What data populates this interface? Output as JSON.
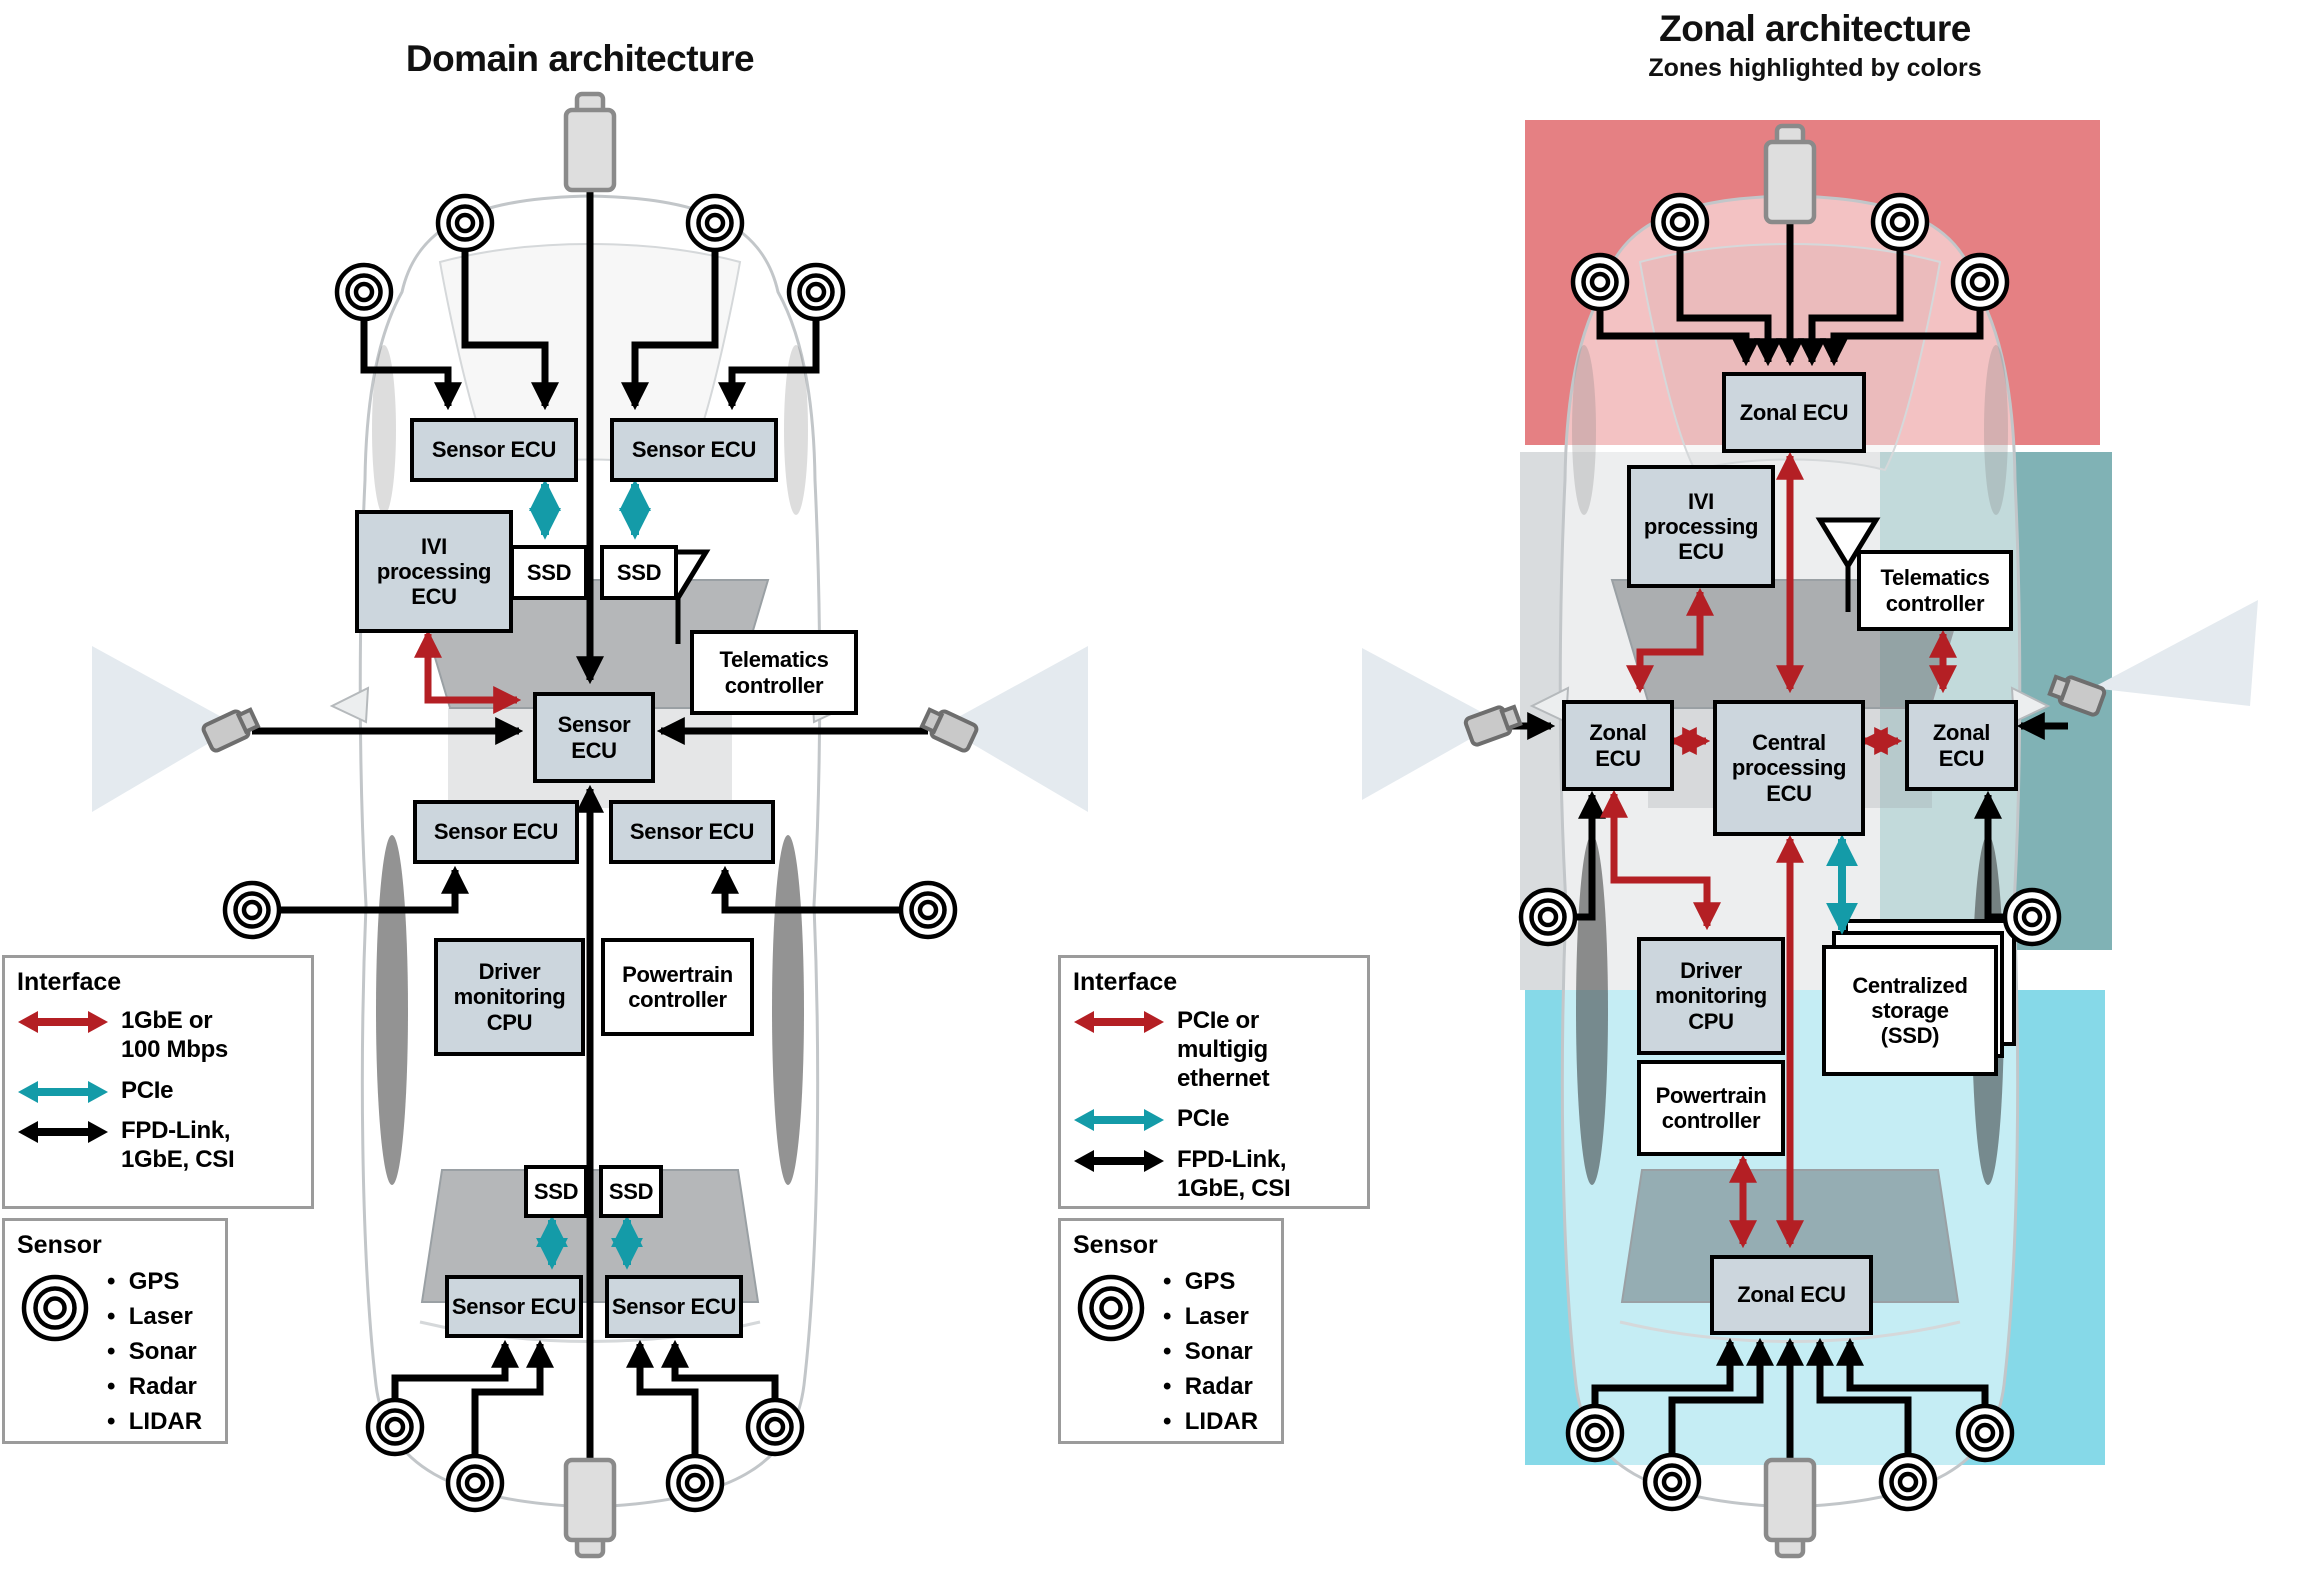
{
  "titles": {
    "domain": "Domain architecture",
    "zonal": "Zonal architecture",
    "zonal_subtitle": "Zones highlighted by colors"
  },
  "labels": {
    "sensor_ecu": "Sensor ECU",
    "sensor_ecu_stacked": "Sensor\nECU",
    "ivi": "IVI\nprocessing\nECU",
    "ssd": "SSD",
    "telematics": "Telematics\ncontroller",
    "driver": "Driver\nmonitoring\nCPU",
    "powertrain": "Powertrain\ncontroller",
    "zonal_ecu": "Zonal ECU",
    "zonal_ecu_stacked": "Zonal\nECU",
    "central": "Central\nprocessing\nECU",
    "storage": "Centralized\nstorage\n(SSD)"
  },
  "legends": {
    "interface_title": "Interface",
    "sensor_title": "Sensor",
    "domain_interface": [
      {
        "icon": "red-double-arrow-icon",
        "color": "#b41f24",
        "label": "1GbE or\n100 Mbps"
      },
      {
        "icon": "teal-double-arrow-icon",
        "color": "#149ba8",
        "label": "PCIe"
      },
      {
        "icon": "black-double-arrow-icon",
        "color": "#000000",
        "label": "FPD-Link,\n1GbE, CSI"
      }
    ],
    "zonal_interface": [
      {
        "icon": "red-double-arrow-icon",
        "color": "#b41f24",
        "label": "PCIe or multigig\nethernet"
      },
      {
        "icon": "teal-double-arrow-icon",
        "color": "#149ba8",
        "label": "PCIe"
      },
      {
        "icon": "black-double-arrow-icon",
        "color": "#000000",
        "label": "FPD-Link,\n1GbE, CSI"
      }
    ],
    "sensor_items": [
      "GPS",
      "Laser",
      "Sonar",
      "Radar",
      "LIDAR"
    ]
  },
  "colors": {
    "ecu_box_fill": "#ccd6dd",
    "white_box_fill": "#ffffff",
    "red_arrow": "#b41f24",
    "teal_arrow": "#149ba8",
    "black_arrow": "#000000",
    "zone_red": "#e58083",
    "zone_teal": "#80b2b5",
    "zone_gray": "#d9dcde",
    "zone_cyan": "#86d9e8"
  }
}
